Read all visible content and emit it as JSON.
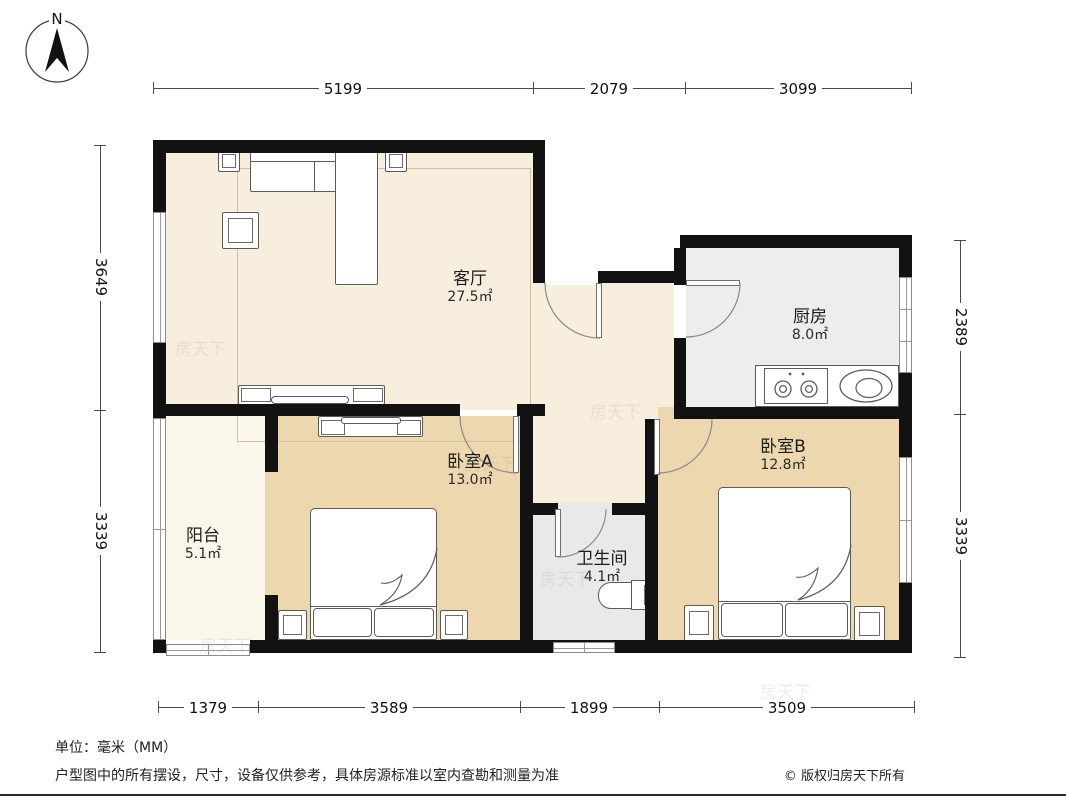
{
  "compass": {
    "label": "N"
  },
  "rooms": {
    "living": {
      "name": "客厅",
      "area": "27.5㎡"
    },
    "kitchen": {
      "name": "厨房",
      "area": "8.0㎡"
    },
    "bedroomA": {
      "name": "卧室A",
      "area": "13.0㎡"
    },
    "bedroomB": {
      "name": "卧室B",
      "area": "12.8㎡"
    },
    "bathroom": {
      "name": "卫生间",
      "area": "4.1㎡"
    },
    "balcony": {
      "name": "阳台",
      "area": "5.1㎡"
    }
  },
  "dimensions": {
    "top": [
      "5199",
      "2079",
      "3099"
    ],
    "bottom": [
      "1379",
      "3589",
      "1899",
      "3509"
    ],
    "left": [
      "3649",
      "3339"
    ],
    "right": [
      "2389",
      "3339"
    ]
  },
  "watermark": "房天下",
  "footer": {
    "unit": "单位：毫米（MM）",
    "disclaimer": "户型图中的所有摆设，尺寸，设备仅供参考，具体房源标准以室内查勘和测量为准",
    "copyright": "© 版权归房天下所有"
  },
  "colors": {
    "wall": "#121212",
    "living_floor": "#f7eedd",
    "bedroom_floor": "#ecd7ae",
    "kitchen_floor": "#ededed",
    "bathroom_floor": "#e9e9e9",
    "balcony_floor": "#fbf6ea"
  }
}
